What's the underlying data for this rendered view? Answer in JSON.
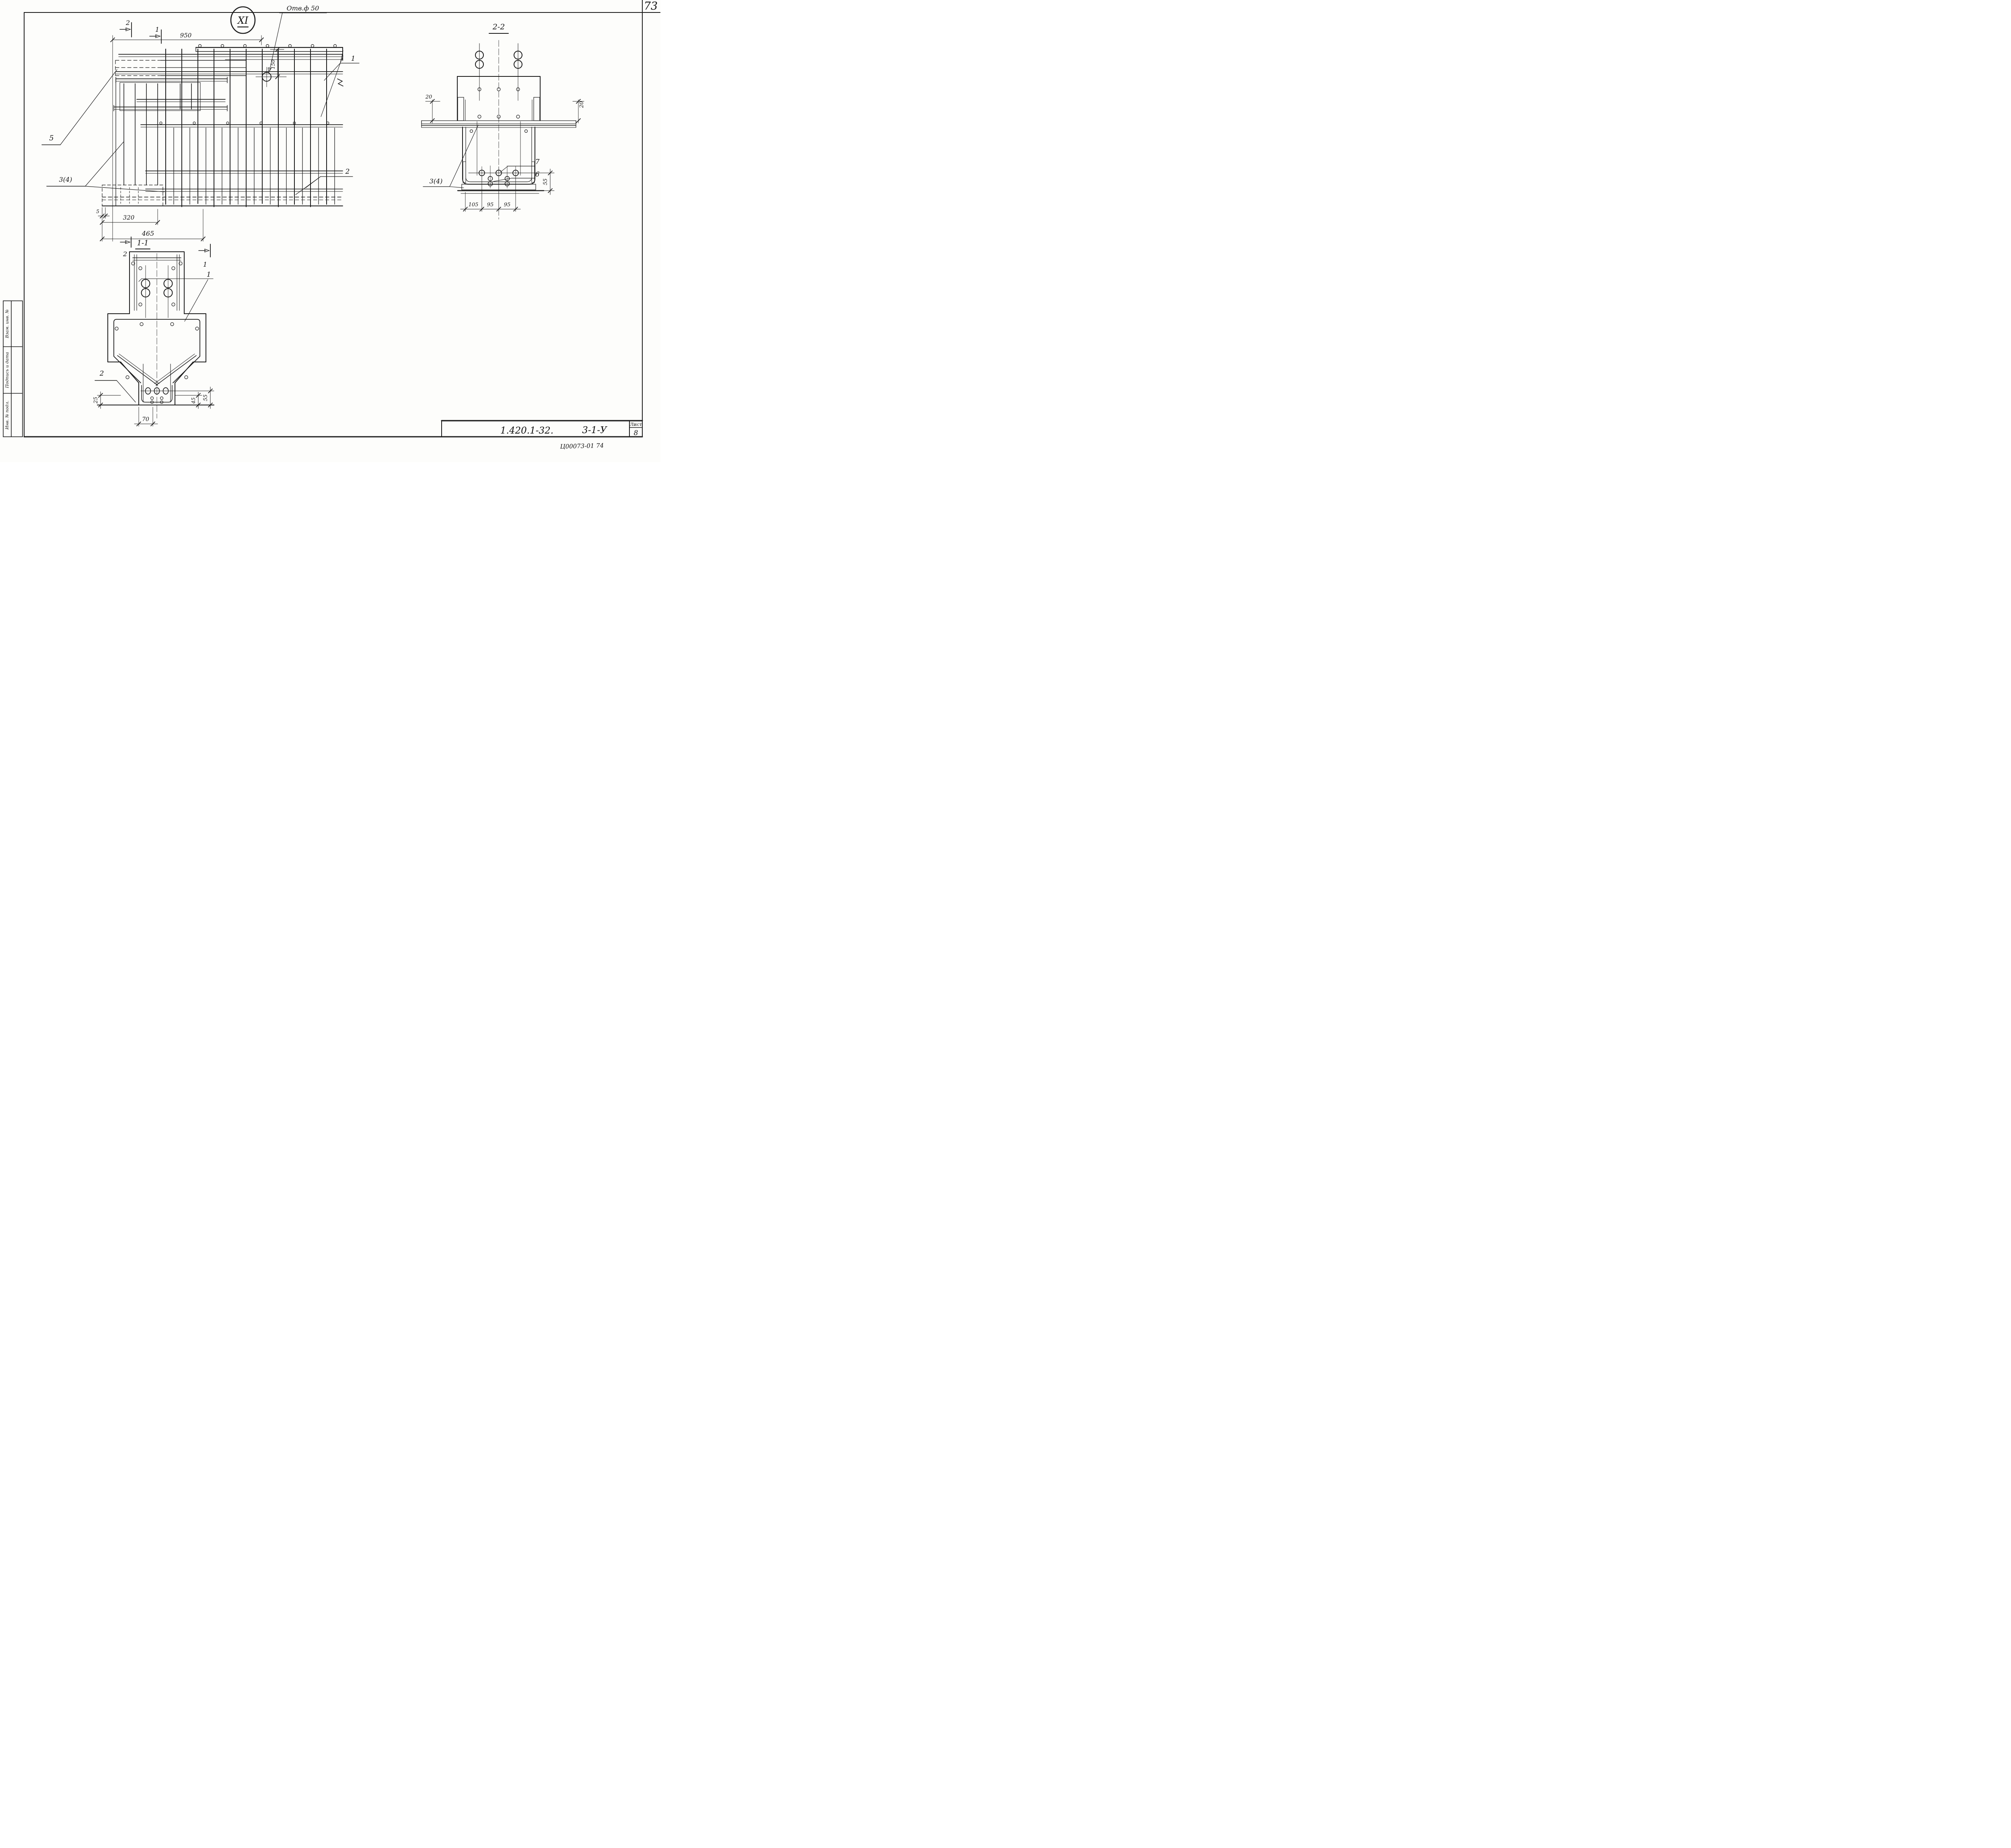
{
  "page": {
    "number": "73",
    "bottom_code": "Ц00073-01 74"
  },
  "title_block": {
    "doc_number": "1.420.1-32.",
    "doc_suffix": "3-1-У",
    "sheet_label": "Лист",
    "sheet_number": "8"
  },
  "side_stamps": {
    "box1": "Взам. инв. №",
    "box2": "Подпись и дата",
    "box3": "Инв. № подл."
  },
  "main_view": {
    "detail_mark": "XI",
    "hole_label": "Отв.ф 50",
    "dim_950": "950",
    "dim_150": "150",
    "dim_5": "5",
    "dim_320": "320",
    "dim_465": "465",
    "marker_2_top": "2",
    "marker_1_top": "1",
    "marker_1_bottom": "1",
    "callout_1": "1",
    "callout_2": "2",
    "callout_5": "5",
    "callout_3_4": "3(4)"
  },
  "section_1_1": {
    "title": "1-1",
    "marker_2": "2",
    "callout_1": "1",
    "callout_2": "2",
    "dim_25": "25",
    "dim_70": "70",
    "dim_45": "45",
    "dim_55": "55"
  },
  "section_2_2": {
    "title": "2-2",
    "dim_20_left": "20",
    "dim_20_right": "20",
    "dim_105": "105",
    "dim_95_a": "95",
    "dim_95_b": "95",
    "dim_55": "55",
    "callout_7": "7",
    "callout_6": "6",
    "callout_3_4": "3(4)"
  }
}
